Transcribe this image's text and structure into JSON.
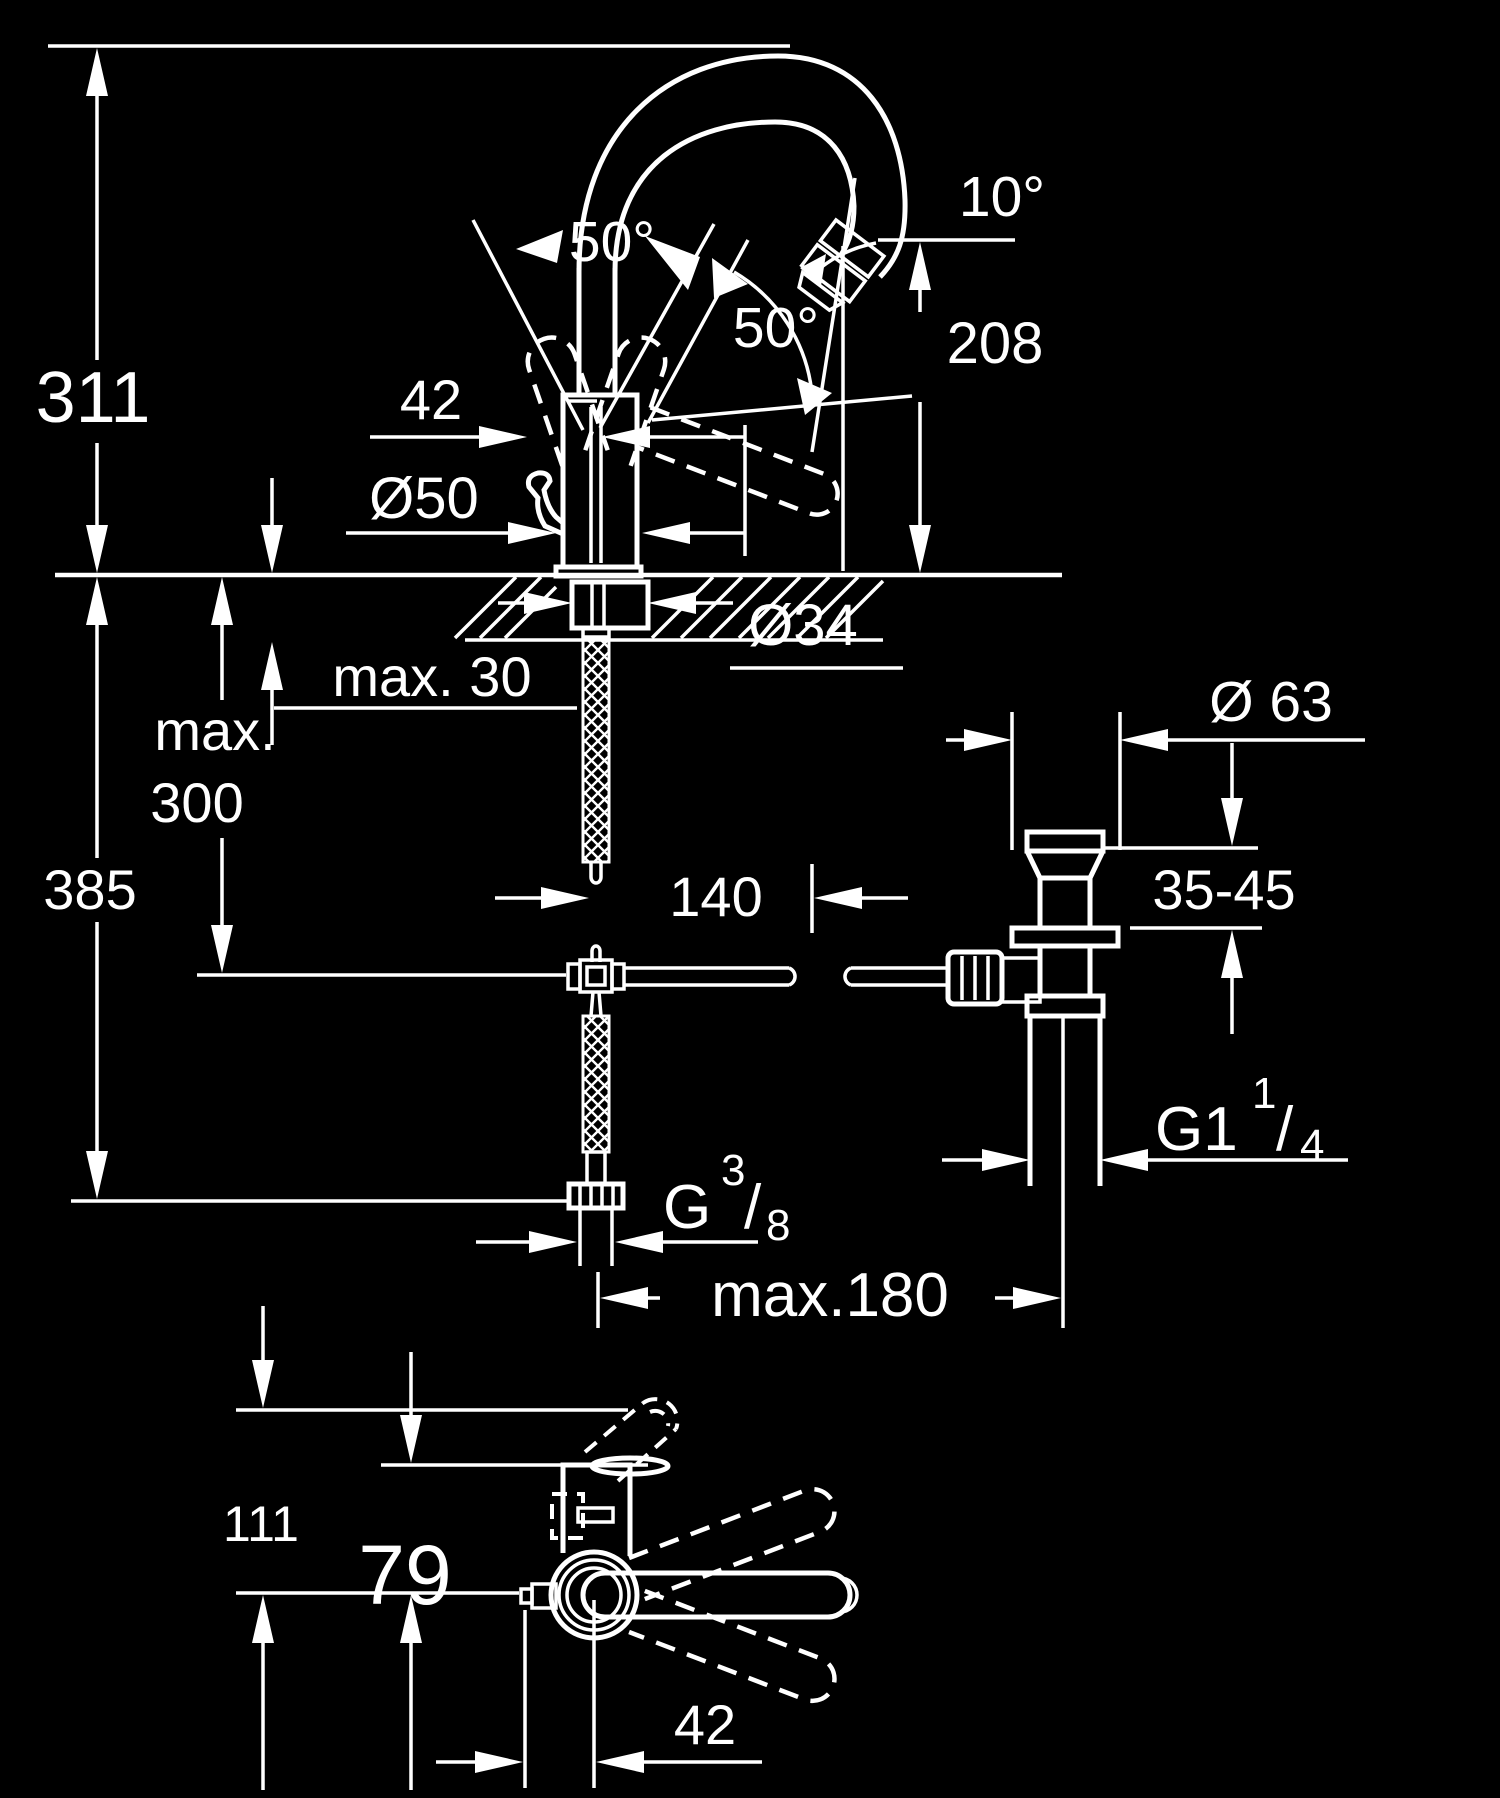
{
  "drawing": {
    "type": "technical-dimension-drawing",
    "subject": "single-lever basin mixer faucet with pop-up waste, side view, drain detail and plan view",
    "background_color": "#000000",
    "line_color": "#ffffff"
  },
  "labels": {
    "side": {
      "h311": "311",
      "h385": "385",
      "max300a": "max.",
      "max300b": "300",
      "max30": "max. 30",
      "d50": "Ø50",
      "w42": "42",
      "d34": "Ø34",
      "a50top": "50°",
      "a50front": "50°",
      "a10": "10°",
      "h208": "208",
      "off140": "140"
    },
    "drain": {
      "d63": "Ø 63",
      "basin": "35-45",
      "g114_main": "G1",
      "g114_num": "1",
      "g114_slash": "/",
      "g114_den": "4"
    },
    "supply": {
      "g38_main": "G",
      "g38_num": "3",
      "g38_slash": "/",
      "g38_den": "8",
      "max180": "max.180"
    },
    "plan": {
      "h111": "111",
      "h79": "79",
      "off42": "42"
    }
  }
}
